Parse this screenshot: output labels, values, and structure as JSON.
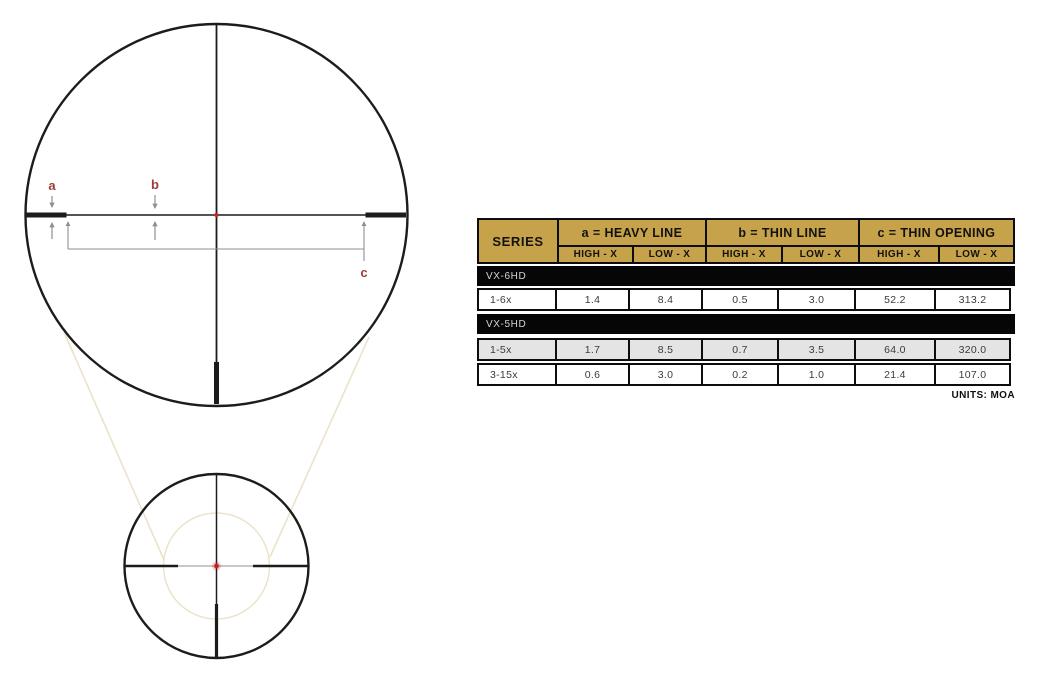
{
  "colors": {
    "gold": "#c6a24b",
    "band-bg": "#060606",
    "band-text": "#d6d4d0",
    "shaded-row": "#e4e4e4",
    "table-border": "#0d0d0d",
    "cell-text": "#3b3b3b",
    "reticle": "#1c1c1a",
    "arrow": "#8f8f8f",
    "label": "#9c3c39",
    "red-dot": "#c5251f",
    "tan": "#ebe3c9",
    "page-bg": "#ffffff"
  },
  "diagram": {
    "label_a": "a",
    "label_b": "b",
    "label_c": "c"
  },
  "table": {
    "series_header": "SERIES",
    "groups": [
      "a = HEAVY LINE",
      "b = THIN LINE",
      "c = THIN OPENING"
    ],
    "subheaders": [
      "HIGH - X",
      "LOW - X",
      "HIGH - X",
      "LOW - X",
      "HIGH - X",
      "LOW - X"
    ],
    "sections": [
      {
        "series": "VX-6HD",
        "rows": [
          {
            "model": "1-6x",
            "values": [
              "1.4",
              "8.4",
              "0.5",
              "3.0",
              "52.2",
              "313.2"
            ]
          }
        ]
      },
      {
        "series": "VX-5HD",
        "rows": [
          {
            "model": "1-5x",
            "values": [
              "1.7",
              "8.5",
              "0.7",
              "3.5",
              "64.0",
              "320.0"
            ]
          },
          {
            "model": "3-15x",
            "values": [
              "0.6",
              "3.0",
              "0.2",
              "1.0",
              "21.4",
              "107.0"
            ]
          }
        ]
      }
    ],
    "units_note": "UNITS: MOA"
  }
}
